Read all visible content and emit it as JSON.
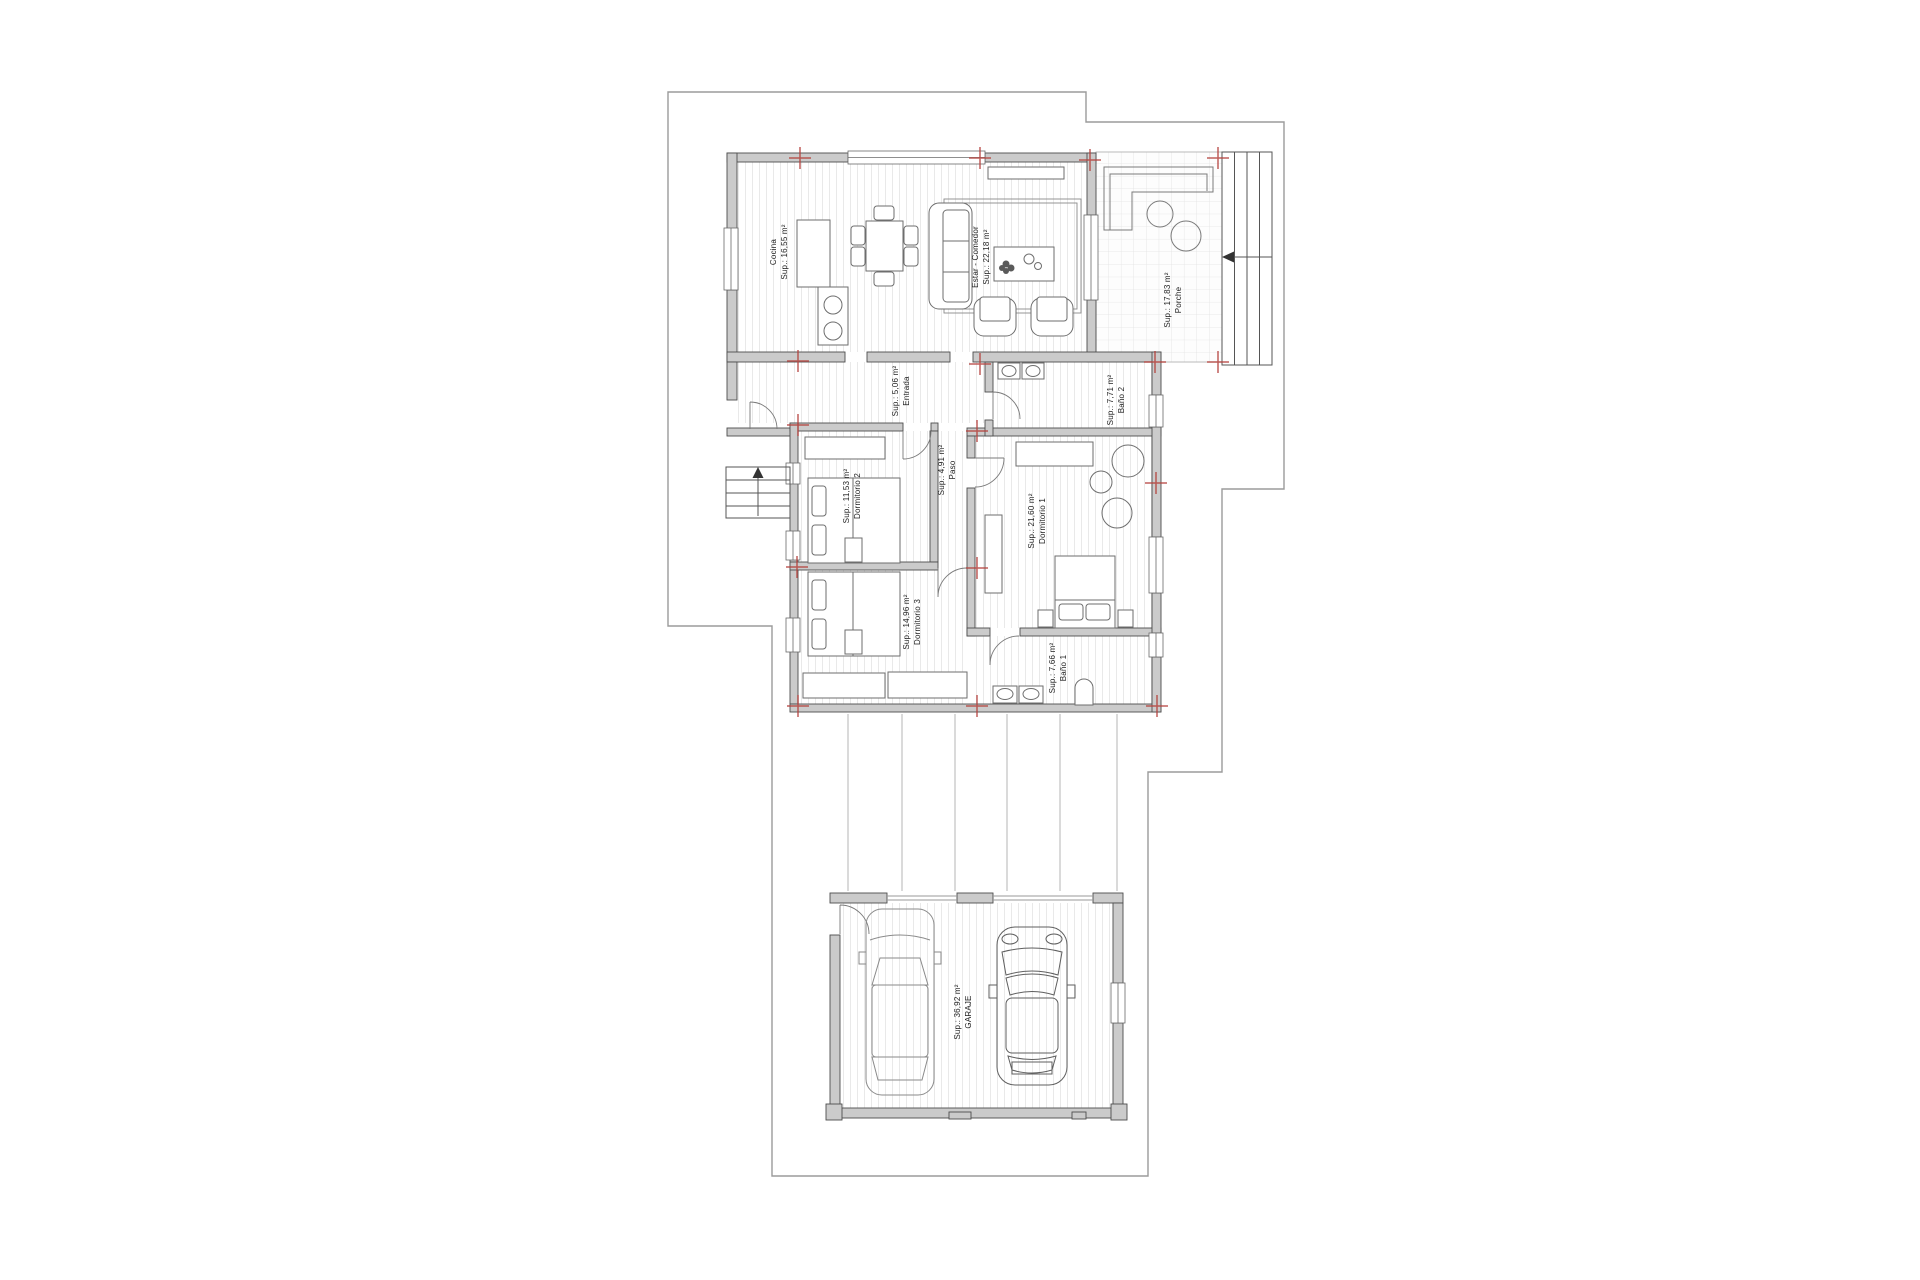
{
  "rooms": {
    "cocina": {
      "name": "Cocina",
      "area": "Sup.: 16,55 m²"
    },
    "estar": {
      "name": "Estar - Comedor",
      "area": "Sup.: 22,18 m²"
    },
    "porche": {
      "name": "Porche",
      "area": "Sup.: 17,83 m²"
    },
    "entrada": {
      "name": "Entrada",
      "area": "Sup.: 5,06 m²"
    },
    "bano2": {
      "name": "Baño 2",
      "area": "Sup.: 7,71 m²"
    },
    "paso": {
      "name": "Paso",
      "area": "Sup.: 4,91 m²"
    },
    "dormitorio2": {
      "name": "Dormitorio 2",
      "area": "Sup.: 11,53 m²"
    },
    "dormitorio1": {
      "name": "Dormitorio 1",
      "area": "Sup.: 21,60 m²"
    },
    "dormitorio3": {
      "name": "Dormitorio 3",
      "area": "Sup.: 14,96 m²"
    },
    "bano1": {
      "name": "Baño 1",
      "area": "Sup.: 7,66 m²"
    },
    "garaje": {
      "name": "GARAJE",
      "area": "Sup.: 36,92 m²"
    }
  },
  "colors": {
    "wall_fill": "#cbcbcb",
    "wall_edge": "#4d4d4d",
    "site_boundary": "#9b9b9b",
    "survey_marker_red": "#b5433e",
    "label_text": "#1f1f1f"
  }
}
